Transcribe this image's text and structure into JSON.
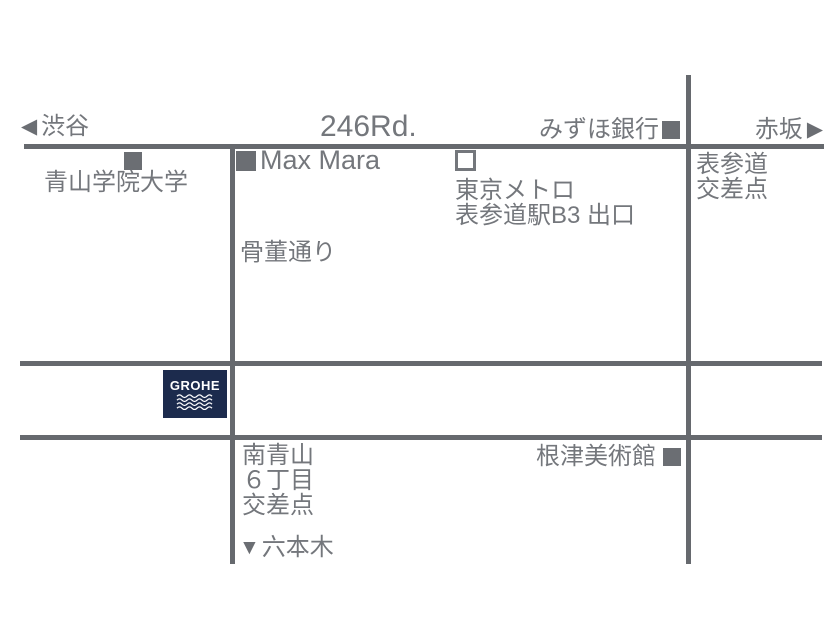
{
  "colors": {
    "road": "#66696e",
    "text": "#74777c",
    "marker": "#6b6e73",
    "grohe_navy": "#1c2b4d",
    "background": "#ffffff"
  },
  "roads": {
    "route246_label": "246Rd.",
    "kotto_street_label": "骨董通り"
  },
  "directions": {
    "west": {
      "arrow": "◀",
      "label": "渋谷"
    },
    "east": {
      "label": "赤坂",
      "arrow": "▶"
    },
    "south": {
      "arrow": "▼",
      "label": "六本木"
    }
  },
  "landmarks": {
    "aoyama_univ": {
      "label": "青山学院大学",
      "marker_icon": "filled-square"
    },
    "max_mara": {
      "label": "Max Mara",
      "marker_icon": "filled-square"
    },
    "mizuho_bank": {
      "label": "みずほ銀行",
      "marker_icon": "filled-square"
    },
    "tokyo_metro": {
      "name": "東京メトロ",
      "exit": "表参道駅B3 出口",
      "marker_icon": "open-square"
    },
    "nezu_museum": {
      "label": "根津美術館",
      "marker_icon": "filled-square"
    }
  },
  "intersections": {
    "omotesando": {
      "line1": "表参道",
      "line2": "交差点"
    },
    "minami_aoyama": {
      "line1": "南青山",
      "line2": "６丁目",
      "line3": "交差点"
    }
  },
  "logo": {
    "brand": "GROHE"
  }
}
